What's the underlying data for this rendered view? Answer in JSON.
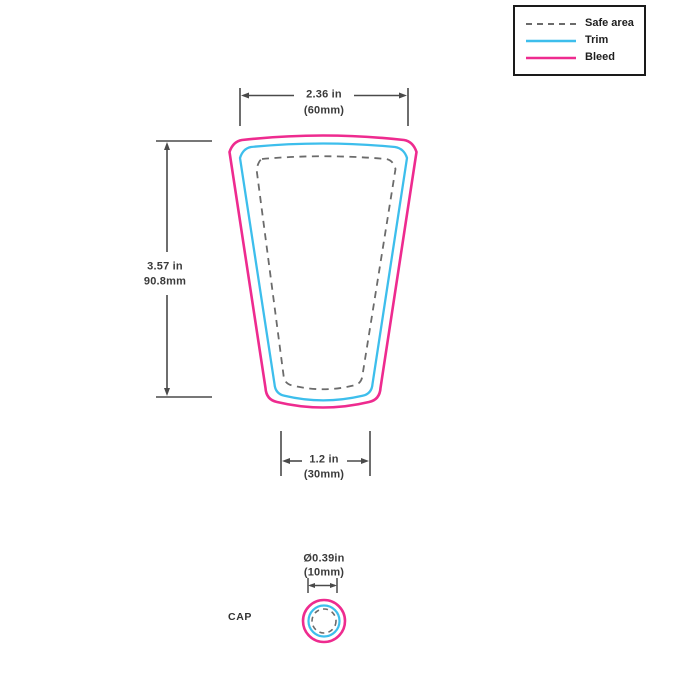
{
  "colors": {
    "bleed": "#EE2B8F",
    "trim": "#3DBEEC",
    "safe_area": "#6B6B6B",
    "dimension": "#4A4A4A"
  },
  "legend": {
    "items": [
      {
        "id": "safe-area",
        "label": "Safe area"
      },
      {
        "id": "trim",
        "label": "Trim"
      },
      {
        "id": "bleed",
        "label": "Bleed"
      }
    ]
  },
  "dimensions": {
    "top_width": {
      "inches": "2.36 in",
      "metric": "(60mm)"
    },
    "height": {
      "inches": "3.57 in",
      "metric": "90.8mm"
    },
    "bottom_width": {
      "inches": "1.2 in",
      "metric": "(30mm)"
    },
    "cap_diameter": {
      "inches": "Ø0.39in",
      "metric": "(10mm)"
    }
  },
  "cap": {
    "label": "CAP"
  }
}
